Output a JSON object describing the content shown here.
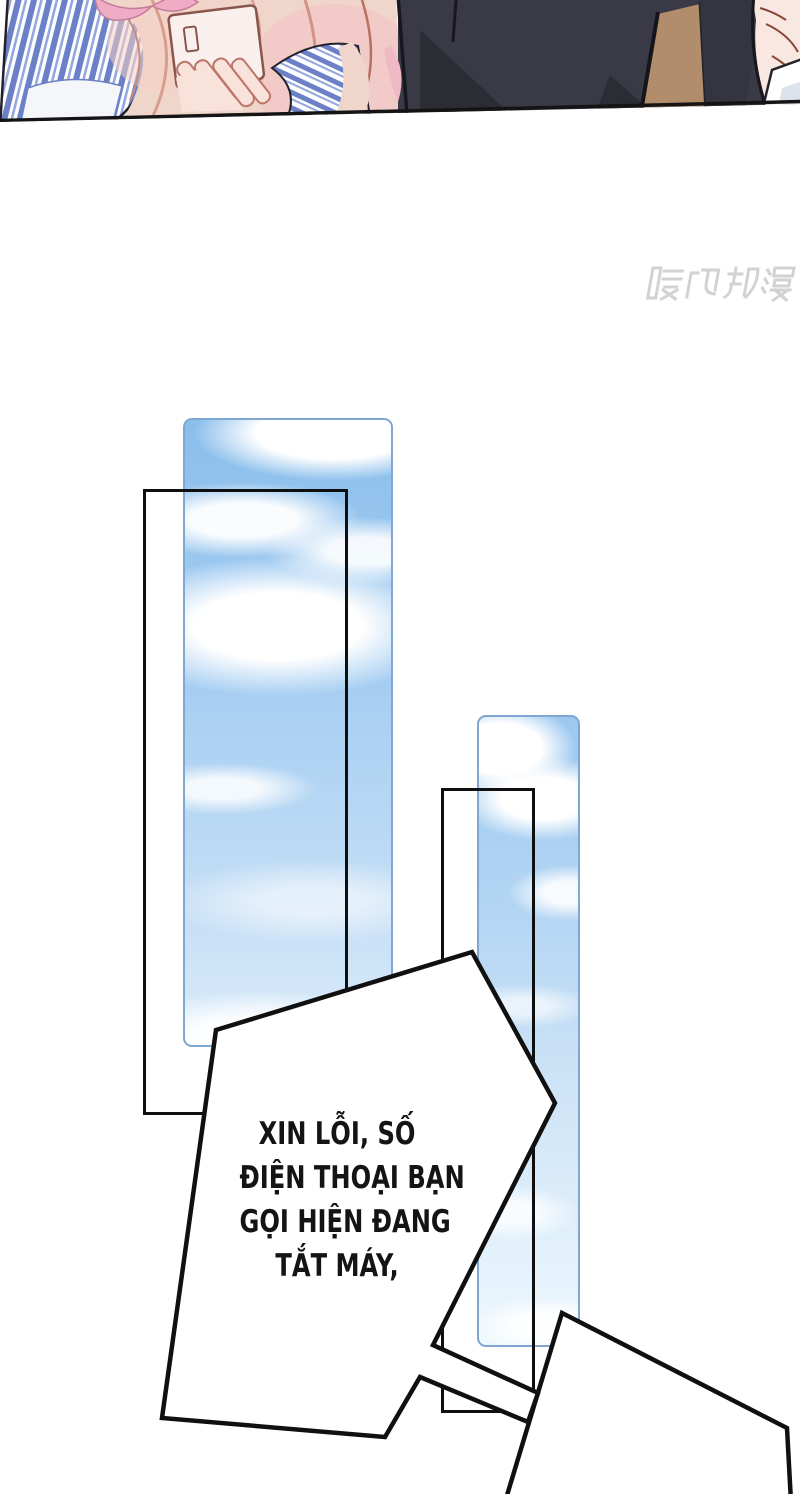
{
  "watermark": {
    "text": "腾讯动漫",
    "color": "#d2d2d2"
  },
  "bubble": {
    "lines": [
      "XIN LỖI, SỐ",
      "ĐIỆN THOẠI BẠN",
      "GỌI HIỆN ĐANG",
      "TẮT MÁY,"
    ],
    "text_color": "#141414",
    "fill": "#ffffff",
    "outline": "#101010"
  },
  "colors": {
    "page_bg": "#ffffff",
    "frame_outline": "#0f0f0f",
    "sky_panel_border": "#7fa7d1",
    "sky_top": "#8abeeb",
    "sky_bottom": "#eef7fd",
    "cloud_white": "#ffffff",
    "stripe_blue": "#6b80c6",
    "hair_blonde": "#f0d6ca",
    "hair_pink": "#f3c3c6",
    "phone_body": "#f9efed",
    "skin": "#f8e2da",
    "suit_dark": "#3a3a46",
    "suit_shadow": "#2c2c35",
    "lapel_tan": "#b28d6c",
    "collar_white": "#ffffff"
  }
}
